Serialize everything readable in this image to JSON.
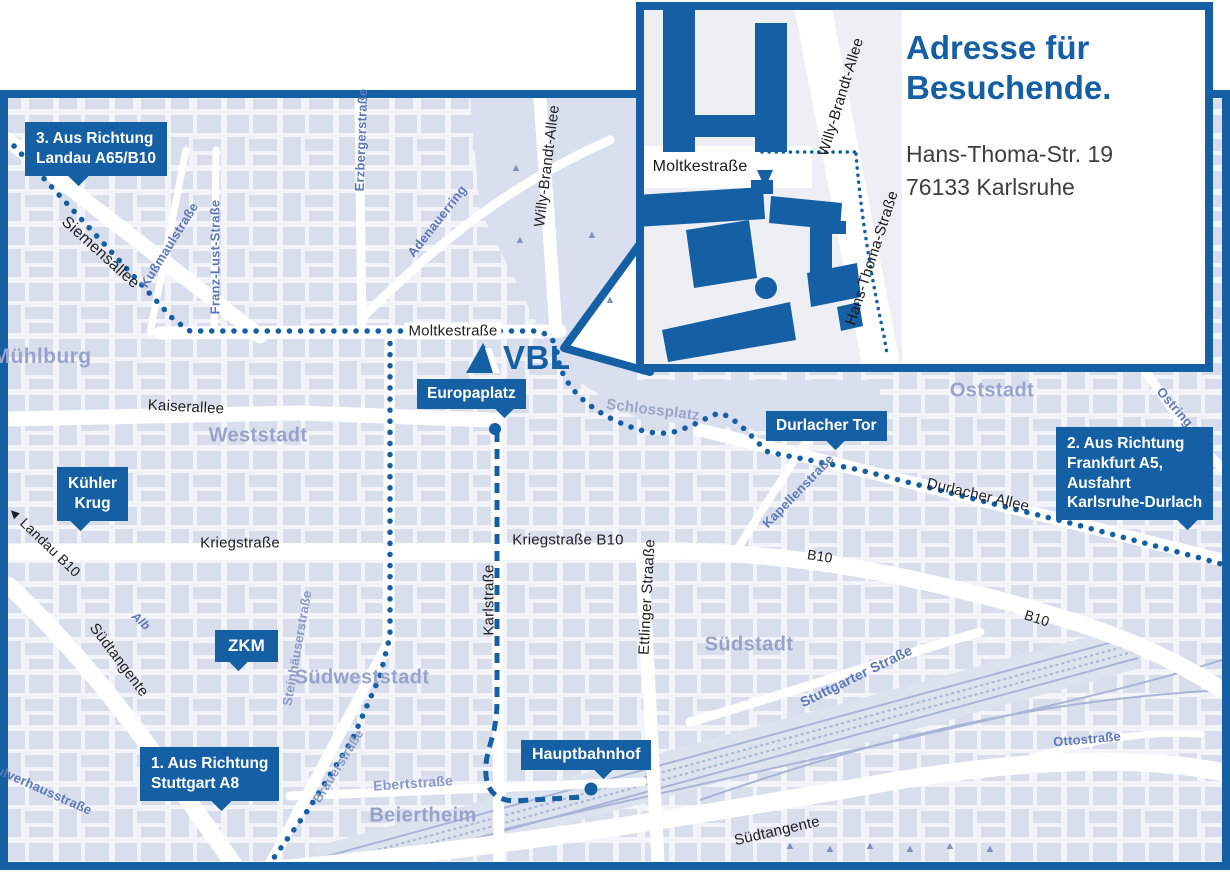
{
  "colors": {
    "accent_blue": "#1560a5",
    "map_bg": "#f2f4f9",
    "block_fill": "#d3d9ea",
    "park": "#d9dfee",
    "area_label": "#97a3cb",
    "street_blue": "#5d77b8",
    "street_muted": "#8b99c5",
    "railway": "#a9b5d6"
  },
  "logo": {
    "text": "VBL"
  },
  "inset": {
    "title_lines": [
      "Adresse für",
      "Besuchende."
    ],
    "address_lines": [
      "Hans-Thoma-Str. 19",
      "76133 Karlsruhe"
    ],
    "streets": {
      "moltkestrasse": "Moltkestraße",
      "willy_brandt_allee": "Willy-Brandt-Allee",
      "hans_thoma_strasse": "Hans-Thoma-Straße"
    }
  },
  "callouts": {
    "landau": {
      "lines": [
        "3. Aus Richtung",
        "Landau A65/B10"
      ]
    },
    "frankfurt": {
      "lines": [
        "2. Aus Richtung",
        "Frankfurt A5,",
        "Ausfahrt",
        "Karlsruhe-Durlach"
      ]
    },
    "stuttgart": {
      "lines": [
        "1. Aus Richtung",
        "Stuttgart A8"
      ]
    },
    "kuehler_krug": {
      "lines": [
        "Kühler",
        "Krug"
      ]
    },
    "zkm": {
      "label": "ZKM"
    },
    "europaplatz": {
      "label": "Europaplatz"
    },
    "durlacher_tor": {
      "label": "Durlacher Tor"
    },
    "hauptbahnhof": {
      "label": "Hauptbahnhof"
    }
  },
  "signs": {
    "landau_b10": {
      "arrow": "◄",
      "text": "Landau B10"
    }
  },
  "streets": {
    "siemensallee": "Siemensallee",
    "moltkestrasse": "Moltkestraße",
    "kaiserallee": "Kaiserallee",
    "kriegstrasse": "Kriegstraße",
    "kriegstrasse_b10": "Kriegstraße B10",
    "karlstrasse": "Karlstraße",
    "ettlinger_strasse": "Ettlinger Straaße",
    "durlacher_allee": "Durlacher Allee",
    "b10": "B10",
    "suedtangente": "Südtangente",
    "willy_brandt_allee": "Willy-Brandt-Allee",
    "kussmaulstrasse": "Kußmaulstraße",
    "franz_lust_strasse": "Franz-Lust-Straße",
    "erzbergerstrasse": "Erzbergerstraße",
    "adenauerring": "Adenauerring",
    "kapellenstrasse": "Kapellenstraße",
    "ostring": "Ostring",
    "steinhaeuserstrasse": "Steinhäuserstraße",
    "brauerstrasse": "Brauerstraße",
    "ebertstrasse": "Ebertstraße",
    "stuttgarter_strasse": "Stuttgarter Straße",
    "ottostrasse": "Ottostraße",
    "alb": "Alb",
    "pulverhausstrasse": "Pulverhausstraße",
    "schlossplatz": "Schlossplatz"
  },
  "areas": {
    "muehlburg": "Mühlburg",
    "weststadt": "Weststadt",
    "oststadt": "Oststadt",
    "suedweststadt": "Südweststadt",
    "suedstadt": "Südstadt",
    "beiertheim": "Beiertheim"
  }
}
